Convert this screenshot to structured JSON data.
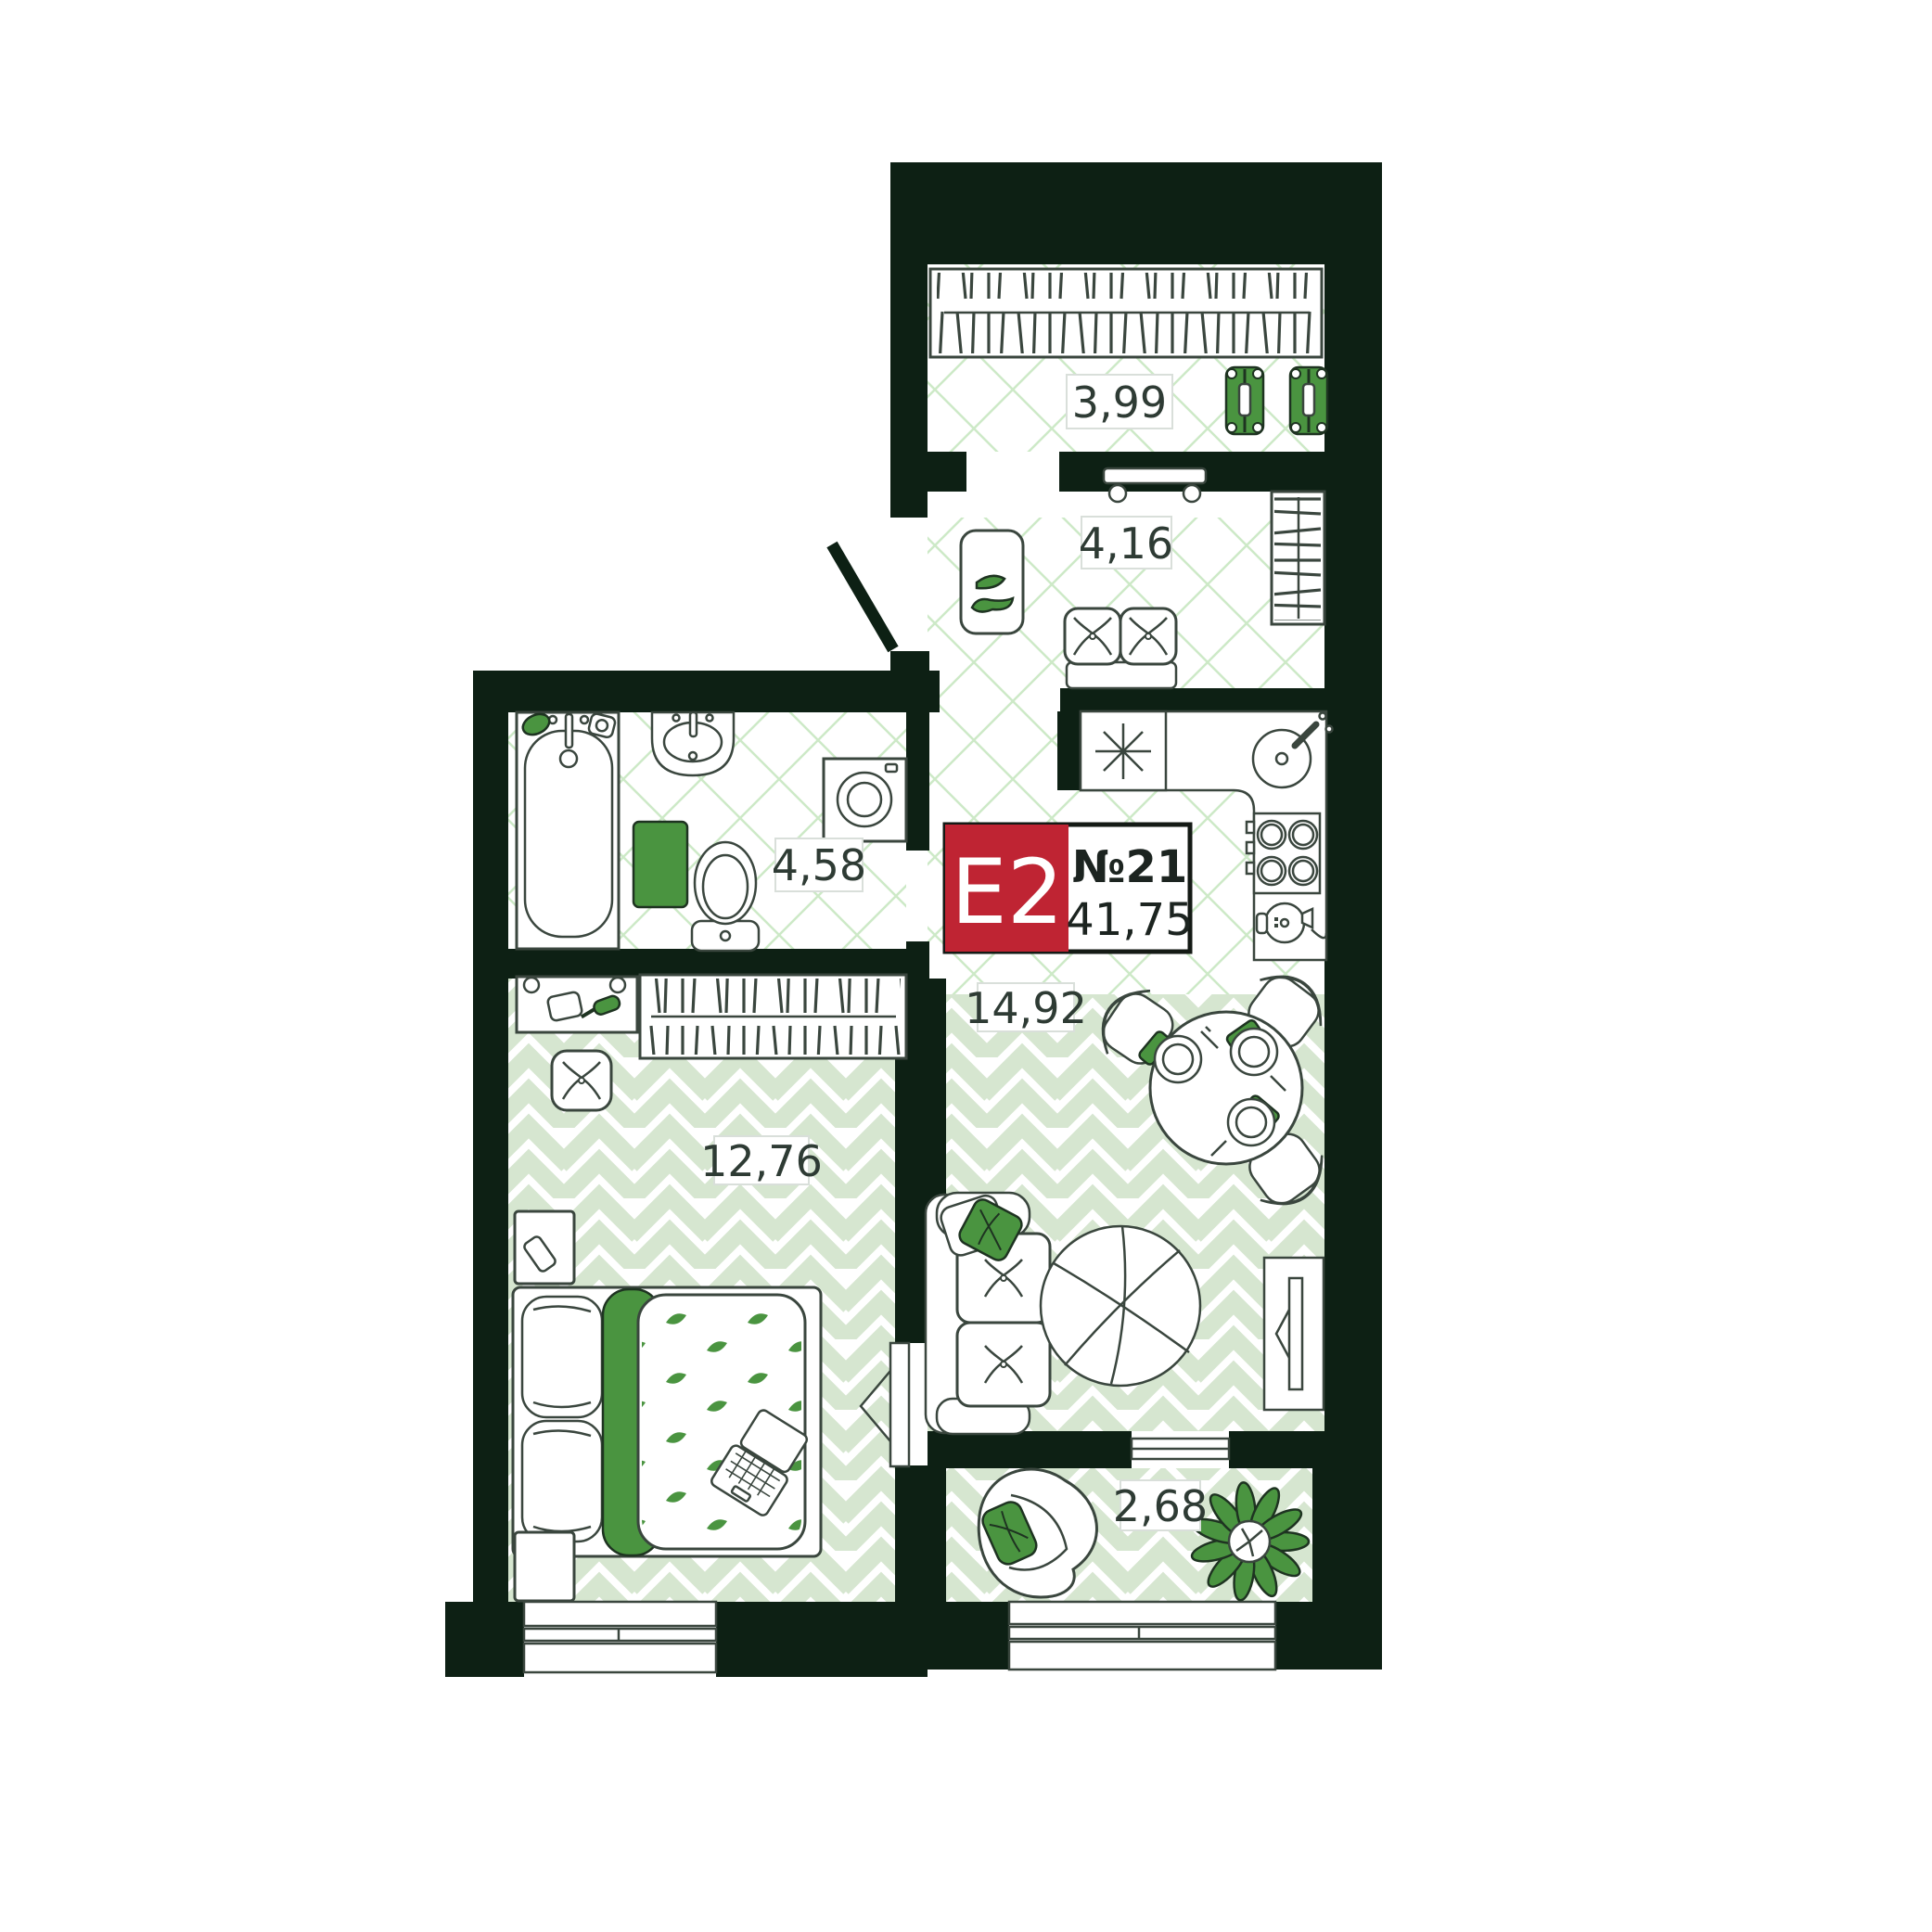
{
  "floorplan": {
    "badge": {
      "layout_code": "E2",
      "unit_number": "№21",
      "total_area": "41,75"
    },
    "rooms": [
      {
        "name": "closet",
        "area": "3,99"
      },
      {
        "name": "hallway",
        "area": "4,16"
      },
      {
        "name": "bathroom",
        "area": "4,58"
      },
      {
        "name": "kitchen-living-room",
        "area": "14,92"
      },
      {
        "name": "bedroom",
        "area": "12,76"
      },
      {
        "name": "balcony",
        "area": "2,68"
      }
    ],
    "colors": {
      "wall": "#0d2014",
      "outline": "#3a463e",
      "accent_green": "#4a9440",
      "floor_tile_green": "#d6e6d0",
      "floor_hatch_green": "#cde9c7",
      "badge_red": "#bf2433"
    },
    "furniture_symbols": [
      "hanger-rail",
      "suitcase",
      "coat-rack",
      "doormat-shoes",
      "bench-pouf",
      "side-wardrobe",
      "hob",
      "round-sink",
      "stove-4-burner",
      "kettle",
      "bathtub",
      "wash-basin",
      "bath-mat",
      "toilet",
      "washing-machine",
      "vanity-table",
      "pouf",
      "nightstand",
      "double-bed",
      "laptop",
      "dining-table",
      "chair",
      "plate-setting",
      "sofa",
      "round-rug",
      "tv-stand",
      "armchair",
      "plant",
      "entrance-door",
      "window"
    ]
  }
}
